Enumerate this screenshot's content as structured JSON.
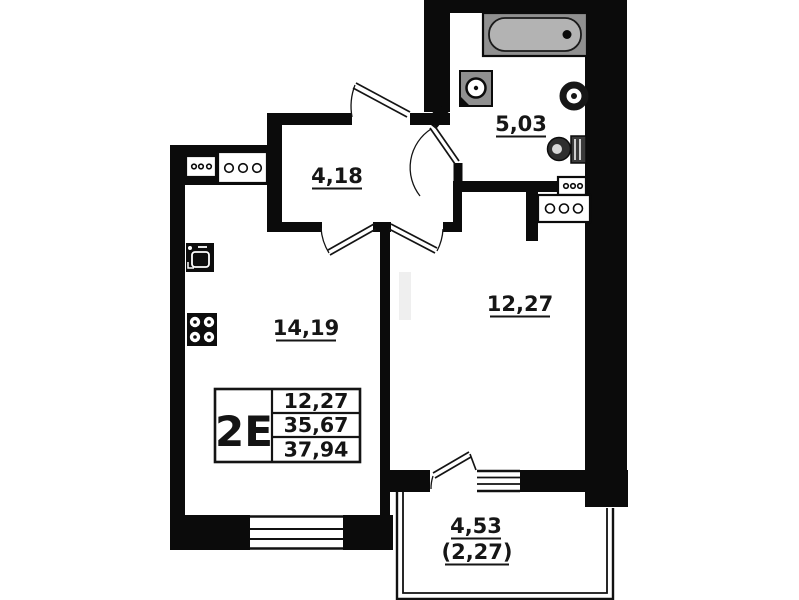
{
  "plan": {
    "unit_type_label": "2E",
    "rooms": {
      "hallway": {
        "area": "4,18"
      },
      "bathroom": {
        "area": "5,03"
      },
      "kitchen": {
        "area": "14,19"
      },
      "room": {
        "area": "12,27"
      },
      "balcony": {
        "area_total": "4,53",
        "area_counted": "(2,27)"
      }
    },
    "info_table": {
      "type_label": "2E",
      "rows": [
        "12,27",
        "35,67",
        "37,94"
      ]
    },
    "fixtures": [
      "bathtub",
      "washbasin",
      "water-heater",
      "toilet",
      "ventilation-block",
      "ventilation-block",
      "ventilation-block",
      "ventilation-block",
      "kitchen-sink",
      "stove"
    ],
    "colors": {
      "wall": "#0b0b0b",
      "background": "#ffffff",
      "fixture_gray": "#909090",
      "text": "#161616"
    }
  }
}
